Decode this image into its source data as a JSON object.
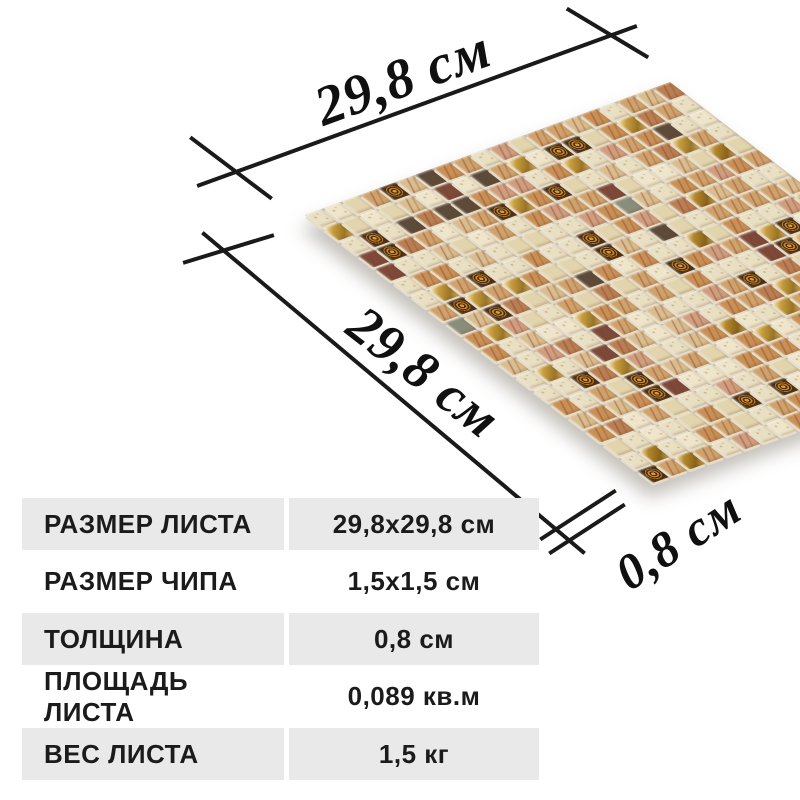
{
  "page": {
    "background": "#ffffff",
    "line_color": "#1a1a1a"
  },
  "dimensions": {
    "sheet_width": {
      "label": "29,8 см"
    },
    "sheet_length": {
      "label": "29,8 см"
    },
    "thickness": {
      "label": "0,8 см"
    }
  },
  "mosaic": {
    "grid": 20,
    "grout_color": "#c3beb0",
    "edge_face_color": "#e6ddc9",
    "palette": [
      {
        "hex": "#e9dfc2",
        "kind": "speck",
        "w": 18
      },
      {
        "hex": "#efe5ca",
        "kind": "speck",
        "w": 10
      },
      {
        "hex": "#e2d4ac",
        "kind": "plain",
        "w": 7
      },
      {
        "hex": "#d9bd8e",
        "kind": "marble",
        "w": 9
      },
      {
        "hex": "#cfa26b",
        "kind": "marble",
        "w": 11
      },
      {
        "hex": "#c89055",
        "kind": "marble",
        "w": 11
      },
      {
        "hex": "#cf9e7e",
        "kind": "marble",
        "w": 7
      },
      {
        "hex": "#b97f52",
        "kind": "marble",
        "w": 5
      },
      {
        "hex": "#c49a3a",
        "kind": "gold",
        "w": 5
      },
      {
        "hex": "#a87d22",
        "kind": "gold",
        "w": 3
      },
      {
        "hex": "#4a2e14",
        "kind": "ornate",
        "w": 6
      },
      {
        "hex": "#5d4a38",
        "kind": "plain",
        "w": 2
      },
      {
        "hex": "#7d4a3a",
        "kind": "marble",
        "w": 2
      },
      {
        "hex": "#8a8d7a",
        "kind": "plain",
        "w": 1
      }
    ]
  },
  "table": {
    "row_bg_odd": "#e9e9e9",
    "row_bg_even": "#ffffff",
    "text_color": "#1b1b1b",
    "rows": [
      {
        "label": "РАЗМЕР ЛИСТА",
        "value": "29,8x29,8 см"
      },
      {
        "label": "РАЗМЕР ЧИПА",
        "value": "1,5x1,5 см"
      },
      {
        "label": "ТОЛЩИНА",
        "value": "0,8 см"
      },
      {
        "label": "ПЛОЩАДЬ ЛИСТА",
        "value": "0,089 кв.м"
      },
      {
        "label": "ВЕС ЛИСТА",
        "value": "1,5 кг"
      }
    ]
  }
}
